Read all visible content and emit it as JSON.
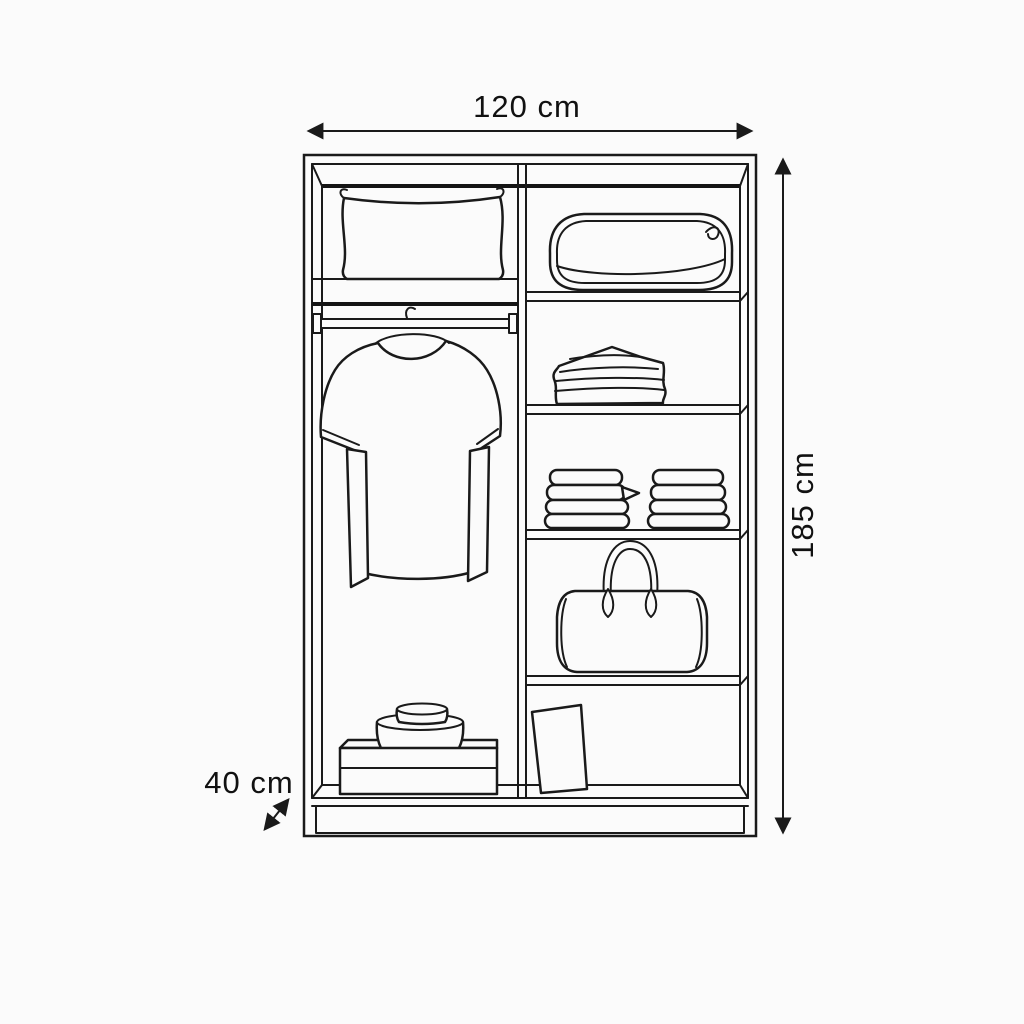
{
  "figure": {
    "type": "wardrobe-front-elevation-line-drawing",
    "left_column_items": [
      "pillow",
      "hanging-rail",
      "t-shirt-on-hanger",
      "storage-box",
      "stacked-round-boxes"
    ],
    "right_column_items": [
      "storage-basket",
      "folded-clothes",
      "towel-stack-left",
      "towel-stack-right",
      "duffel-bag",
      "leaning-flat-box"
    ]
  },
  "dimensions": {
    "width": {
      "label": "120 cm",
      "value_cm": 120
    },
    "height": {
      "label": "185 cm",
      "value_cm": 185
    },
    "depth": {
      "label": "40 cm",
      "value_cm": 40
    }
  },
  "colors": {
    "background": "#fbfbfb",
    "line": "#1a1a1a",
    "text": "#111111"
  }
}
